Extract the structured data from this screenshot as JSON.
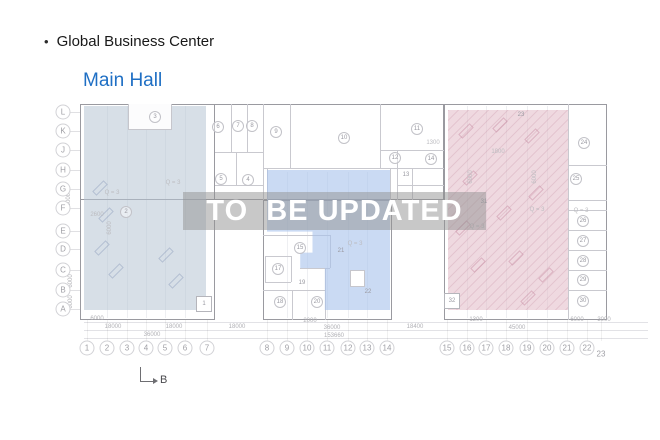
{
  "header": {
    "bullet": "•",
    "title": "Global Business Center",
    "room_title": "Main Hall"
  },
  "watermark": {
    "text": "TO  BE UPDATED"
  },
  "section_arrow": {
    "label": "B"
  },
  "plan": {
    "colors": {
      "room_title_blue": "#1f6fc4",
      "left_zone": "rgba(183,197,212,0.55)",
      "middle_zone": "rgba(166,193,235,0.60)",
      "right_zone": "rgba(226,186,199,0.55)",
      "watermark_bg": "rgba(145,145,145,0.50)",
      "outline_gray": "#9a9aa0"
    },
    "row_labels": [
      {
        "t": "L",
        "x": 63,
        "y": 112
      },
      {
        "t": "K",
        "x": 63,
        "y": 131
      },
      {
        "t": "J",
        "x": 63,
        "y": 150
      },
      {
        "t": "H",
        "x": 63,
        "y": 170
      },
      {
        "t": "G",
        "x": 63,
        "y": 189
      },
      {
        "t": "F",
        "x": 63,
        "y": 208
      },
      {
        "t": "E",
        "x": 63,
        "y": 231
      },
      {
        "t": "D",
        "x": 63,
        "y": 249
      },
      {
        "t": "C",
        "x": 63,
        "y": 270
      },
      {
        "t": "B",
        "x": 63,
        "y": 290
      },
      {
        "t": "A",
        "x": 63,
        "y": 309
      }
    ],
    "col_labels": [
      {
        "t": "1",
        "x": 87,
        "y": 348
      },
      {
        "t": "2",
        "x": 107,
        "y": 348
      },
      {
        "t": "3",
        "x": 127,
        "y": 348
      },
      {
        "t": "4",
        "x": 146,
        "y": 348
      },
      {
        "t": "5",
        "x": 165,
        "y": 348
      },
      {
        "t": "6",
        "x": 185,
        "y": 348
      },
      {
        "t": "7",
        "x": 207,
        "y": 348
      },
      {
        "t": "8",
        "x": 267,
        "y": 348
      },
      {
        "t": "9",
        "x": 287,
        "y": 348
      },
      {
        "t": "10",
        "x": 307,
        "y": 348
      },
      {
        "t": "11",
        "x": 327,
        "y": 348
      },
      {
        "t": "12",
        "x": 348,
        "y": 348
      },
      {
        "t": "13",
        "x": 367,
        "y": 348
      },
      {
        "t": "14",
        "x": 387,
        "y": 348
      },
      {
        "t": "15",
        "x": 447,
        "y": 348
      },
      {
        "t": "16",
        "x": 467,
        "y": 348
      },
      {
        "t": "17",
        "x": 486,
        "y": 348
      },
      {
        "t": "18",
        "x": 506,
        "y": 348
      },
      {
        "t": "19",
        "x": 527,
        "y": 348
      },
      {
        "t": "20",
        "x": 547,
        "y": 348
      },
      {
        "t": "21",
        "x": 567,
        "y": 348
      },
      {
        "t": "22",
        "x": 587,
        "y": 348
      },
      {
        "t": "23",
        "x": 601,
        "y": 354,
        "style": "plain"
      }
    ],
    "rooms": [
      {
        "t": "2",
        "x": 126,
        "y": 212
      },
      {
        "t": "3",
        "x": 155,
        "y": 117
      },
      {
        "t": "5",
        "x": 221,
        "y": 179
      },
      {
        "t": "4",
        "x": 248,
        "y": 180
      },
      {
        "t": "6",
        "x": 218,
        "y": 127
      },
      {
        "t": "7",
        "x": 238,
        "y": 126
      },
      {
        "t": "8",
        "x": 252,
        "y": 126
      },
      {
        "t": "9",
        "x": 276,
        "y": 132
      },
      {
        "t": "10",
        "x": 344,
        "y": 138
      },
      {
        "t": "11",
        "x": 417,
        "y": 129
      },
      {
        "t": "12",
        "x": 395,
        "y": 158
      },
      {
        "t": "14",
        "x": 431,
        "y": 159
      },
      {
        "t": "13",
        "x": 406,
        "y": 175,
        "style": "plain"
      },
      {
        "t": "15",
        "x": 300,
        "y": 248
      },
      {
        "t": "17",
        "x": 278,
        "y": 269
      },
      {
        "t": "18",
        "x": 280,
        "y": 302
      },
      {
        "t": "20",
        "x": 317,
        "y": 302
      },
      {
        "t": "19",
        "x": 302,
        "y": 283,
        "style": "plain"
      },
      {
        "t": "21",
        "x": 341,
        "y": 251,
        "style": "plain"
      },
      {
        "t": "22",
        "x": 368,
        "y": 292,
        "style": "plain"
      },
      {
        "t": "1",
        "x": 204,
        "y": 304,
        "style": "box"
      },
      {
        "t": "23",
        "x": 521,
        "y": 115,
        "style": "plain"
      },
      {
        "t": "31",
        "x": 484,
        "y": 202,
        "style": "plain"
      },
      {
        "t": "32",
        "x": 452,
        "y": 301,
        "style": "box"
      },
      {
        "t": "24",
        "x": 584,
        "y": 143
      },
      {
        "t": "25",
        "x": 576,
        "y": 179
      },
      {
        "t": "26",
        "x": 583,
        "y": 221
      },
      {
        "t": "27",
        "x": 583,
        "y": 241
      },
      {
        "t": "28",
        "x": 583,
        "y": 261
      },
      {
        "t": "29",
        "x": 583,
        "y": 280
      },
      {
        "t": "30",
        "x": 583,
        "y": 301
      }
    ],
    "texts": [
      {
        "t": "Q = 3",
        "x": 173,
        "y": 183
      },
      {
        "t": "Q = 3",
        "x": 112,
        "y": 193
      },
      {
        "t": "2600",
        "x": 97,
        "y": 215
      },
      {
        "t": "6000",
        "x": 110,
        "y": 228,
        "v": true
      },
      {
        "t": "Q = 3",
        "x": 355,
        "y": 244
      },
      {
        "t": "Q = 3",
        "x": 537,
        "y": 210
      },
      {
        "t": "Q = 3",
        "x": 477,
        "y": 227
      },
      {
        "t": "Q = 3",
        "x": 581,
        "y": 211
      },
      {
        "t": "1300",
        "x": 433,
        "y": 143
      },
      {
        "t": "1800",
        "x": 498,
        "y": 152
      },
      {
        "t": "6000",
        "x": 471,
        "y": 177,
        "v": true
      },
      {
        "t": "6000",
        "x": 535,
        "y": 177,
        "v": true
      }
    ],
    "dims_bottom": [
      {
        "t": "6000",
        "x": 97,
        "y": 319
      },
      {
        "t": "2000",
        "x": 310,
        "y": 321
      },
      {
        "t": "1300",
        "x": 476,
        "y": 320
      },
      {
        "t": "6000",
        "x": 577,
        "y": 320
      },
      {
        "t": "3000",
        "x": 604,
        "y": 320
      },
      {
        "t": "18000",
        "x": 113,
        "y": 327
      },
      {
        "t": "18000",
        "x": 174,
        "y": 327
      },
      {
        "t": "18000",
        "x": 237,
        "y": 327
      },
      {
        "t": "36000",
        "x": 332,
        "y": 328
      },
      {
        "t": "18400",
        "x": 415,
        "y": 327
      },
      {
        "t": "45000",
        "x": 517,
        "y": 328
      },
      {
        "t": "36000",
        "x": 152,
        "y": 335
      },
      {
        "t": "153660",
        "x": 334,
        "y": 336
      }
    ],
    "dims_left": [
      {
        "t": "60000",
        "x": 69,
        "y": 198,
        "v": true
      },
      {
        "t": "6000",
        "x": 71,
        "y": 281,
        "v": true
      },
      {
        "t": "6000",
        "x": 71,
        "y": 302,
        "v": true
      }
    ]
  }
}
